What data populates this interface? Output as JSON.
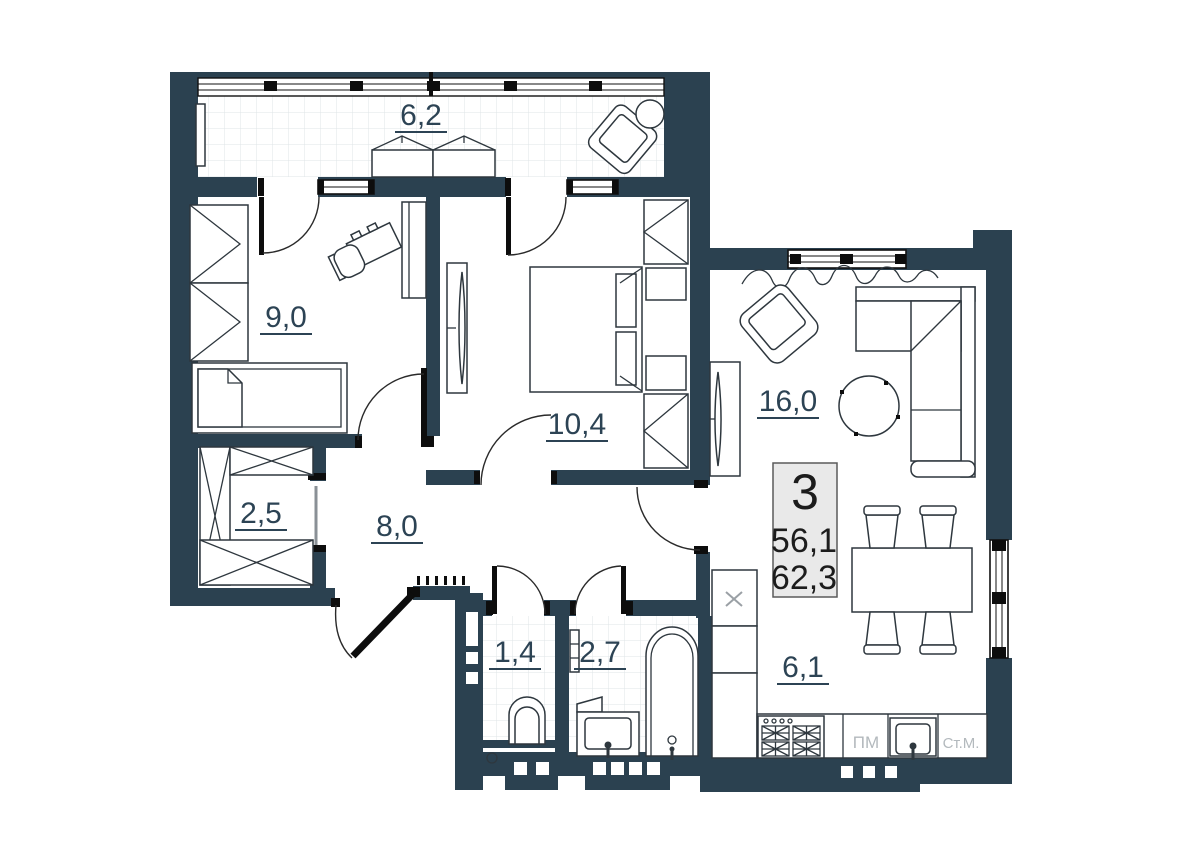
{
  "plan": {
    "unit_info": {
      "rooms_count": "3",
      "living_area": "56,1",
      "total_area": "62,3"
    },
    "room_areas": {
      "balcony": "6,2",
      "bedroom_small": "9,0",
      "bedroom_master": "10,4",
      "living_room": "16,0",
      "storage": "2,5",
      "hallway": "8,0",
      "wc": "1,4",
      "bathroom": "2,7",
      "kitchen": "6,1"
    },
    "appliance_labels": {
      "dishwasher": "ПМ",
      "washing_machine": "Ст.М."
    },
    "colors": {
      "wall": "#2b4150",
      "label": "#2c4354",
      "info_box_bg": "#e9e9e9",
      "tile_line": "#dfe4e7",
      "appliance_text": "#b3b9bd"
    }
  }
}
